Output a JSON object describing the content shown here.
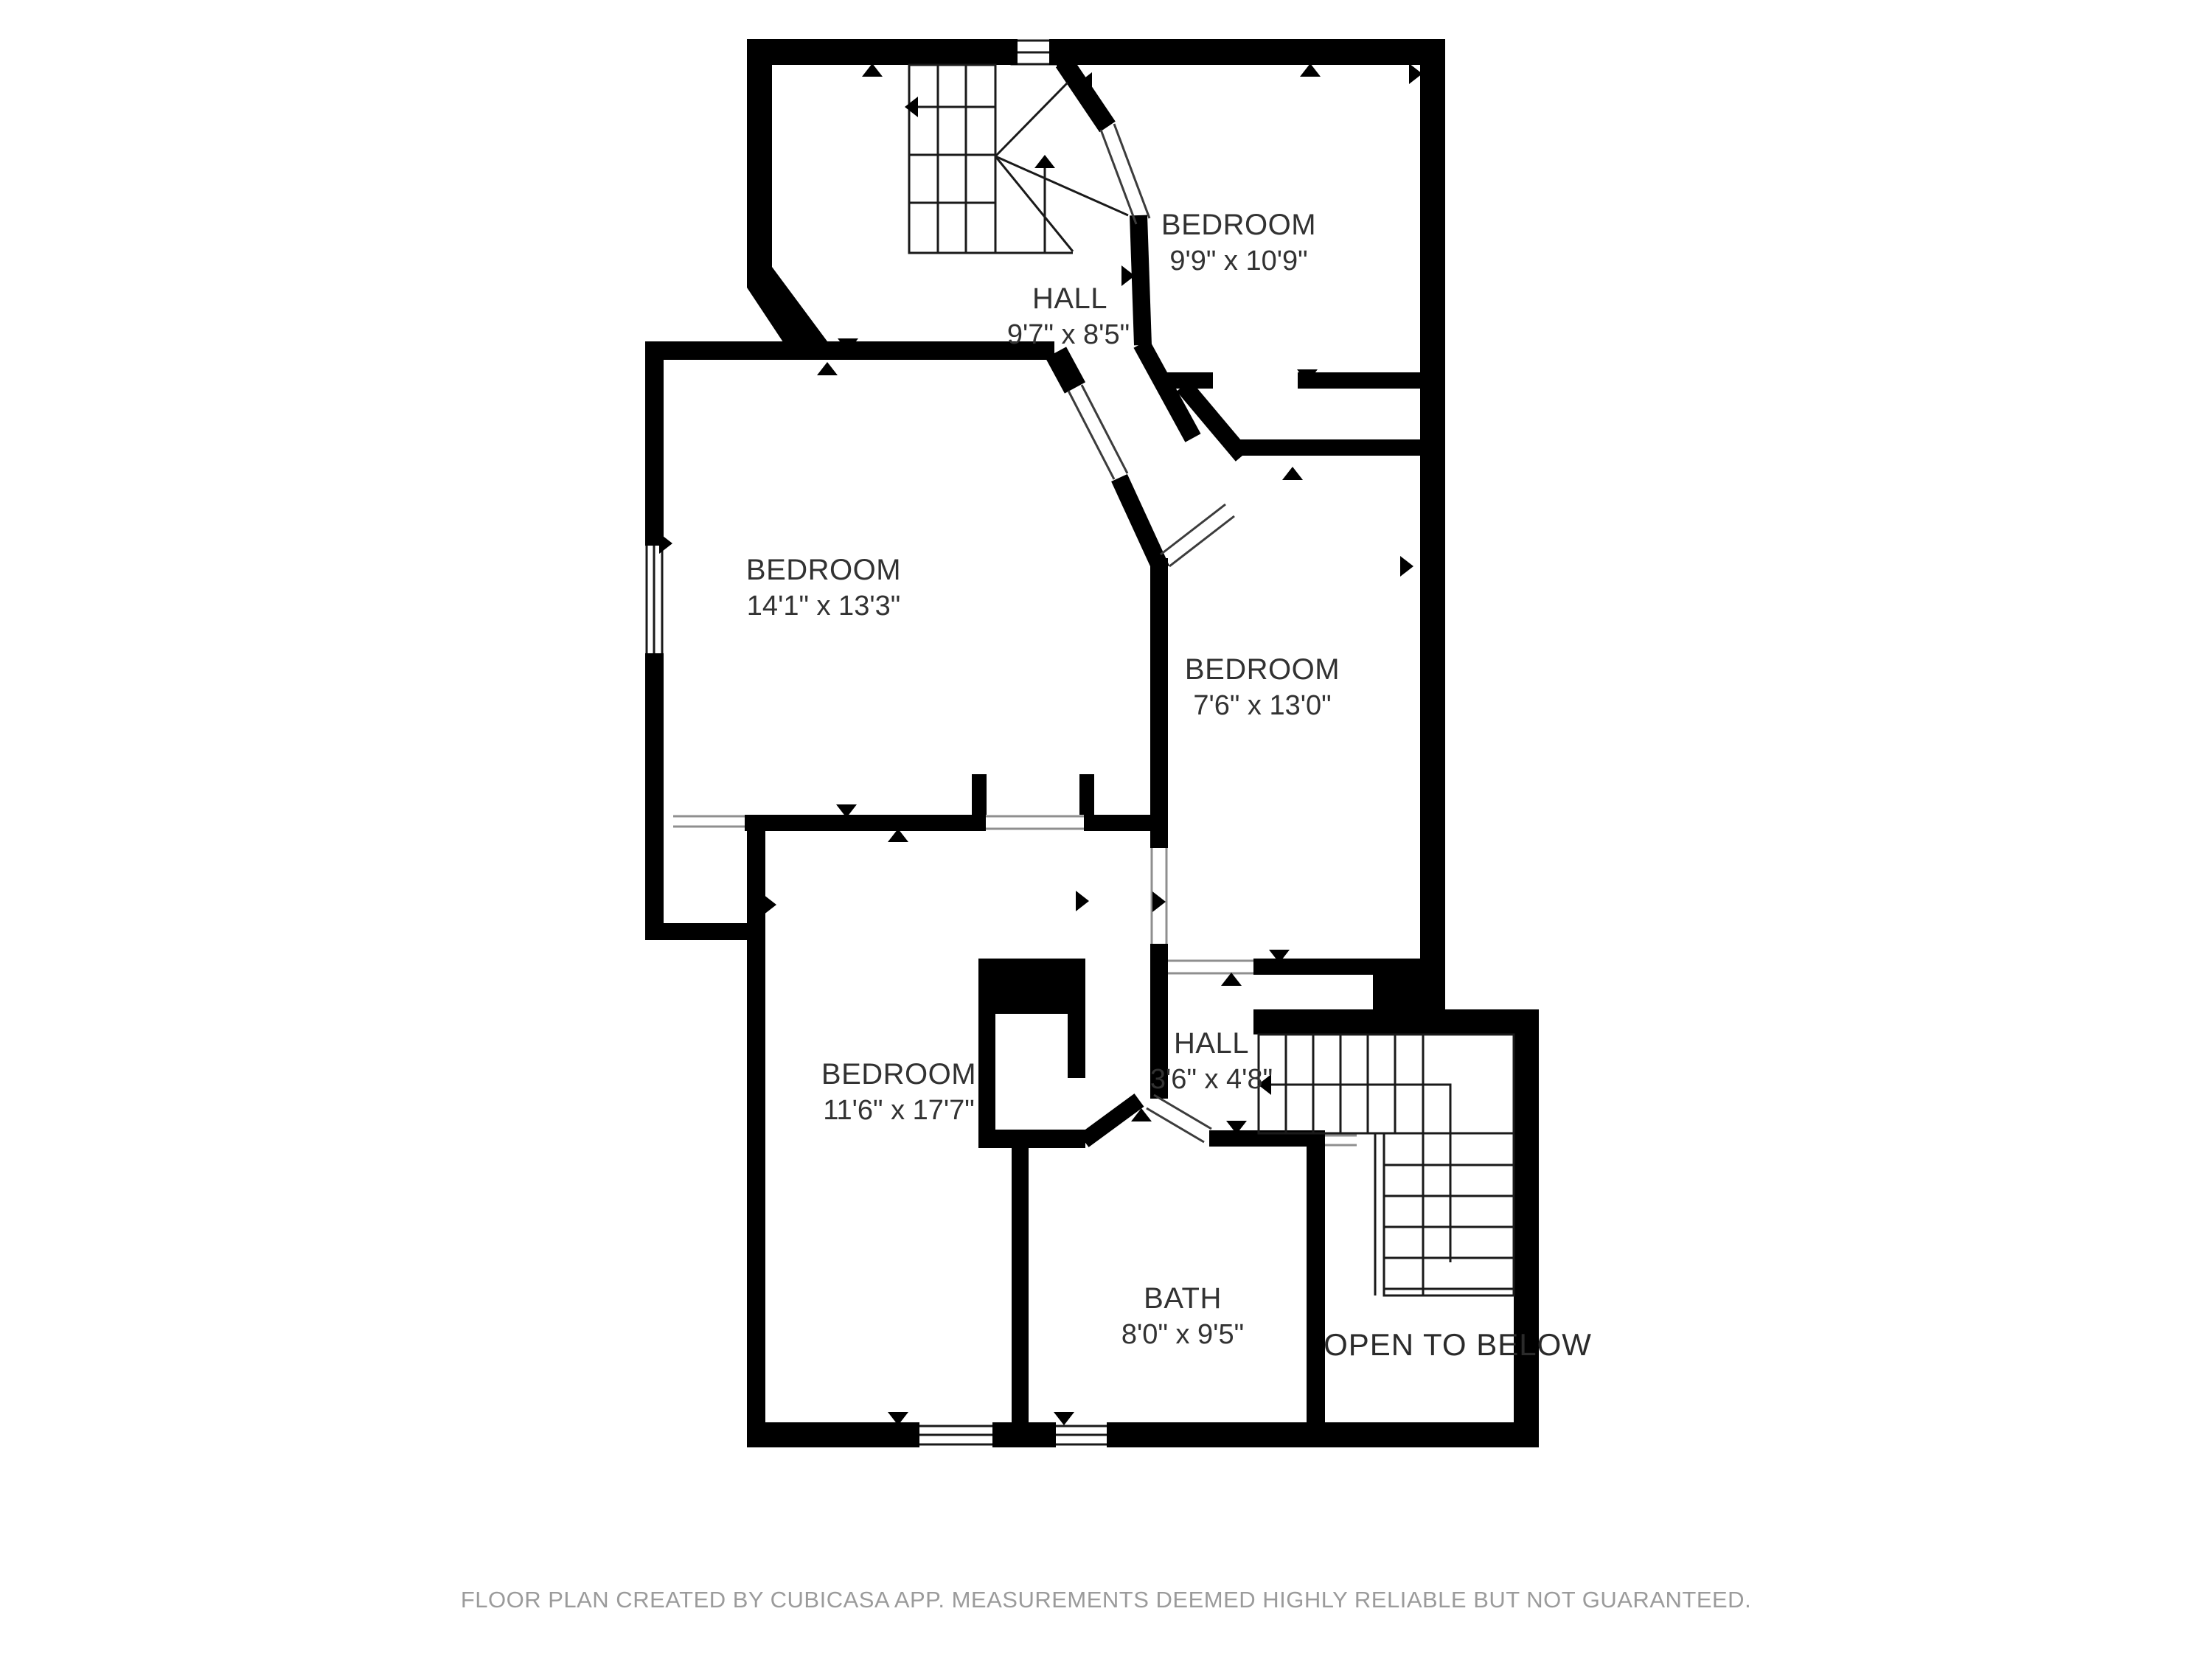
{
  "floor_plan": {
    "rooms": {
      "hall_upper": {
        "name": "HALL",
        "dims": "9'7\" x 8'5\""
      },
      "bedroom_top_right": {
        "name": "BEDROOM",
        "dims": "9'9\" x 10'9\""
      },
      "bedroom_mid_left": {
        "name": "BEDROOM",
        "dims": "14'1\" x 13'3\""
      },
      "bedroom_mid_right": {
        "name": "BEDROOM",
        "dims": "7'6\" x 13'0\""
      },
      "bedroom_bottom_left": {
        "name": "BEDROOM",
        "dims": "11'6\" x 17'7\""
      },
      "hall_lower": {
        "name": "HALL",
        "dims": "3'6\" x 4'8\""
      },
      "bath": {
        "name": "BATH",
        "dims": "8'0\" x 9'5\""
      },
      "open_to_below": {
        "label": "OPEN TO BELOW"
      }
    },
    "features": {
      "upper_stairs": "winder staircase with up and left direction arrows",
      "lower_stairs": "L-shaped staircase with left direction arrow",
      "windows": 4,
      "door_markers": "black triangle door indicators"
    },
    "colors": {
      "wall": "#000000",
      "label": "#323232",
      "footer": "#9b9b9b",
      "background": "#ffffff"
    }
  },
  "footer": {
    "text": "FLOOR PLAN CREATED BY CUBICASA APP. MEASUREMENTS DEEMED HIGHLY RELIABLE BUT NOT GUARANTEED."
  }
}
